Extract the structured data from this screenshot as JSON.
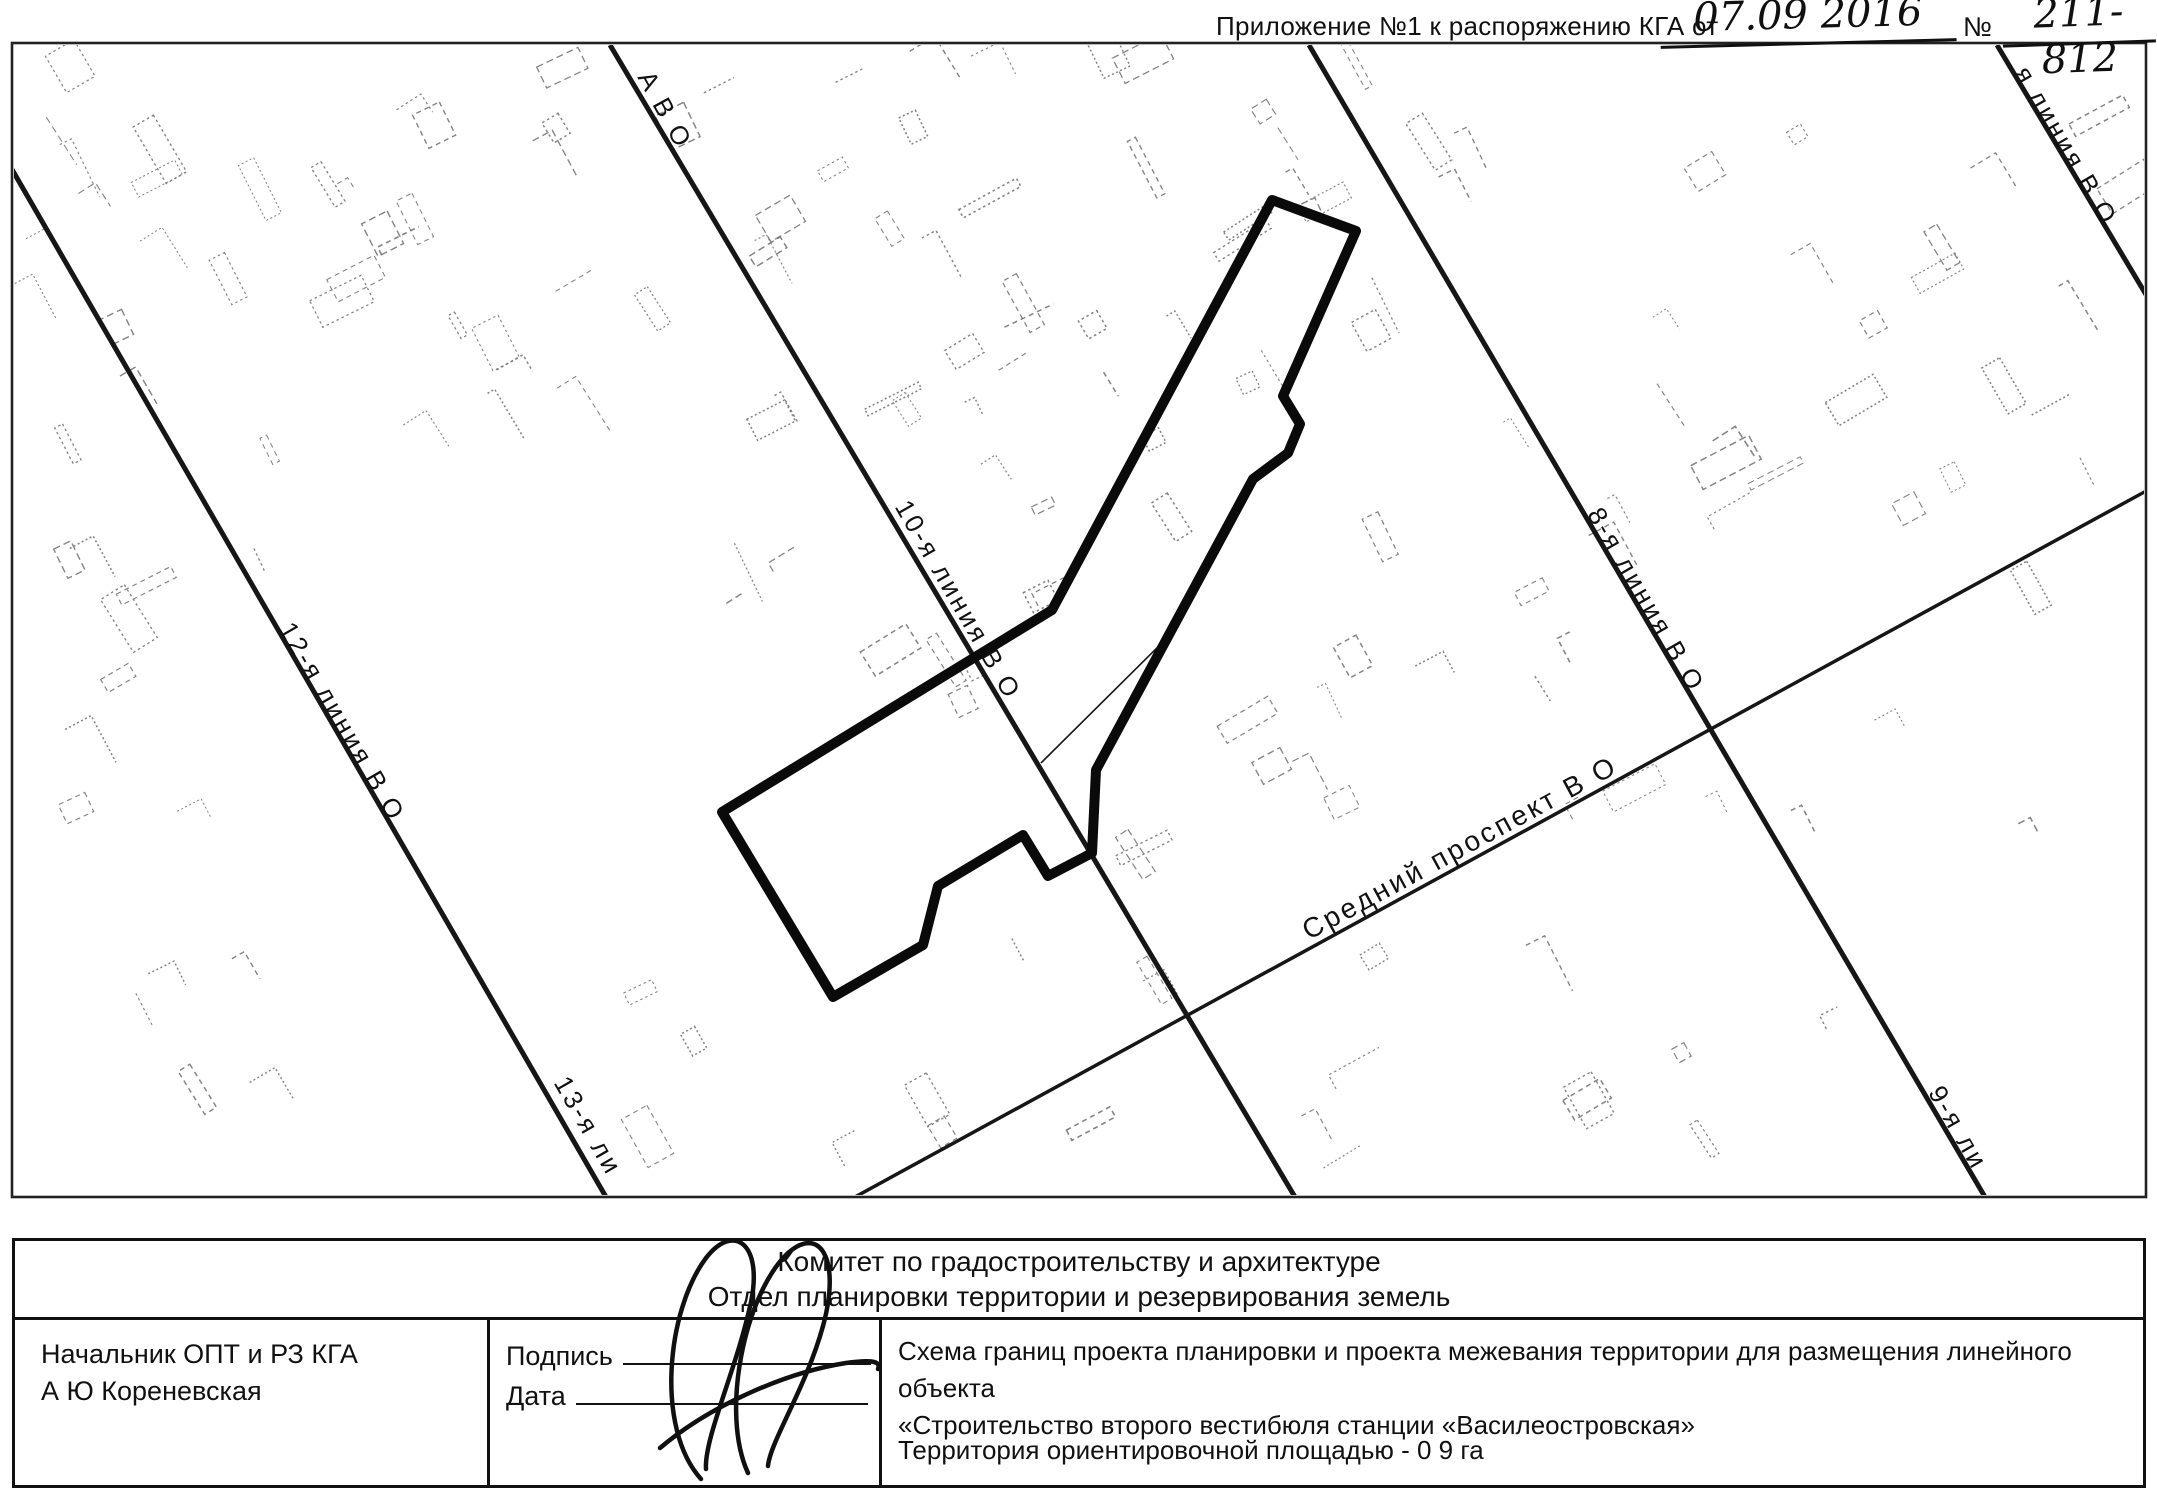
{
  "header": {
    "label": "Приложение №1 к распоряжению КГА от",
    "date_handwritten": "07.09 2016",
    "number_sign": "№",
    "number_handwritten": "211-812"
  },
  "map": {
    "frame": {
      "x": 12,
      "y": 43,
      "w": 2134,
      "h": 1154
    },
    "streets": [
      {
        "name": "line-12-13",
        "x1": 10,
        "y1": 166,
        "x2": 606,
        "y2": 1197,
        "width": 5
      },
      {
        "name": "line-10",
        "x1": 610,
        "y1": 45,
        "x2": 1295,
        "y2": 1197,
        "width": 5
      },
      {
        "name": "line-8-9",
        "x1": 1309,
        "y1": 45,
        "x2": 1985,
        "y2": 1197,
        "width": 5
      },
      {
        "name": "line-7",
        "x1": 1997,
        "y1": 45,
        "x2": 2148,
        "y2": 298,
        "width": 5
      },
      {
        "name": "sredny-prospekt",
        "x1": 855,
        "y1": 1197,
        "x2": 2148,
        "y2": 490,
        "width": 3.5
      },
      {
        "name": "minor-lot-line",
        "x1": 1170,
        "y1": 635,
        "x2": 1041,
        "y2": 763,
        "width": 1.6
      }
    ],
    "street_labels": [
      {
        "text": "А В О",
        "x": 665,
        "y": 110,
        "rot": 61,
        "size": 26
      },
      {
        "text": "я линия В О",
        "x": 2066,
        "y": 146,
        "rot": 60,
        "size": 26
      },
      {
        "text": "10-я линия В О",
        "x": 958,
        "y": 600,
        "rot": 60,
        "size": 26
      },
      {
        "text": "12-я линия В О",
        "x": 342,
        "y": 722,
        "rot": 60,
        "size": 26
      },
      {
        "text": "13-я ли",
        "x": 588,
        "y": 1126,
        "rot": 60,
        "size": 26
      },
      {
        "text": "8-я линия В О",
        "x": 1646,
        "y": 600,
        "rot": 60,
        "size": 26
      },
      {
        "text": "9-я ли",
        "x": 1958,
        "y": 1128,
        "rot": 60,
        "size": 26
      },
      {
        "text": "Средний проспект В О",
        "x": 1460,
        "y": 848,
        "rot": -28.5,
        "size": 28
      }
    ],
    "boundary_polygon": {
      "stroke_width": 10,
      "color": "#0a0a0a",
      "points": [
        [
          1272,
          200
        ],
        [
          1356,
          231
        ],
        [
          1283,
          396
        ],
        [
          1300,
          424
        ],
        [
          1288,
          453
        ],
        [
          1253,
          479
        ],
        [
          1096,
          770
        ],
        [
          1092,
          853
        ],
        [
          1048,
          876
        ],
        [
          1023,
          835
        ],
        [
          938,
          886
        ],
        [
          923,
          945
        ],
        [
          833,
          997
        ],
        [
          722,
          812
        ],
        [
          1052,
          610
        ]
      ]
    },
    "texture": {
      "color": "#6e6e6e",
      "clusters": [
        {
          "x": 30,
          "y": 55,
          "w": 560,
          "h": 430,
          "n": 34
        },
        {
          "x": 40,
          "y": 500,
          "w": 260,
          "h": 330,
          "n": 9
        },
        {
          "x": 620,
          "y": 55,
          "w": 580,
          "h": 400,
          "n": 30
        },
        {
          "x": 700,
          "y": 470,
          "w": 480,
          "h": 260,
          "n": 12
        },
        {
          "x": 1230,
          "y": 55,
          "w": 900,
          "h": 430,
          "n": 36
        },
        {
          "x": 1340,
          "y": 500,
          "w": 720,
          "h": 380,
          "n": 18
        },
        {
          "x": 600,
          "y": 940,
          "w": 740,
          "h": 240,
          "n": 11
        },
        {
          "x": 1320,
          "y": 950,
          "w": 740,
          "h": 210,
          "n": 9
        },
        {
          "x": 60,
          "y": 860,
          "w": 380,
          "h": 280,
          "n": 5
        },
        {
          "x": 1060,
          "y": 700,
          "w": 270,
          "h": 200,
          "n": 6
        }
      ]
    }
  },
  "title_block": {
    "org_line1": "Комитет по градостроительству и архитектуре",
    "org_line2": "Отдел планировки территории и резервирования земель",
    "official_position": "Начальник ОПТ и РЗ КГА",
    "official_name": "А Ю  Кореневская",
    "signature_label": "Подпись",
    "date_label": "Дата",
    "scheme_title_line1": "Схема границ проекта планировки и проекта межевания территории для размещения линейного объекта",
    "scheme_title_line2": "«Строительство второго вестибюля станции «Василеостровская»",
    "area_note": "Территория  ориентировочной площадью - 0 9 га",
    "signature_paths": [
      "M 701,1479 C 655,1428 667,1310 706,1258 C 734,1222 763,1244 751,1302 C 737,1368 704,1438 706,1469",
      "M 748,1473 C 720,1412 745,1296 786,1255 C 818,1224 842,1256 823,1326 C 806,1388 770,1442 768,1466",
      "M 660,1448 C 712,1404 788,1372 846,1363 C 874,1359 881,1362 878,1369"
    ]
  }
}
